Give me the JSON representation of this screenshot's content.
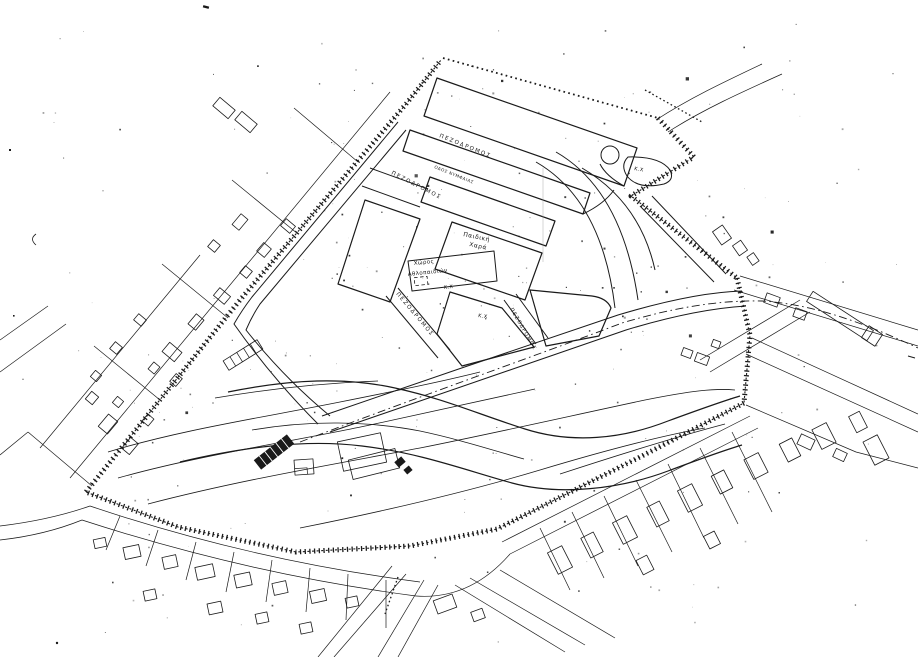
{
  "map": {
    "type": "scanned-urban-plan",
    "paper_color": "#ffffff",
    "ink_color": "#1a1a1a",
    "street_labels": [
      {
        "id": "pezodromos-1",
        "text": "ΠΕΖΟΔΡΟΜΟΣ"
      },
      {
        "id": "pezodromos-2",
        "text": "ΠΕΖΟΔΡΟΜΟΣ"
      },
      {
        "id": "pezodromos-3",
        "text": "ΠΕΖΟΔΡΟΜΟΣ"
      },
      {
        "id": "pezodromos-4",
        "text": "ΠΕΖΟΔΡΟΜΟΣ"
      },
      {
        "id": "street-name",
        "text": "ΟΔΟΣ ΝΥΜΦΑΙΑΣ"
      }
    ],
    "area_labels": [
      {
        "id": "playground",
        "line1": "Παιδική",
        "line2": "Χαρά"
      },
      {
        "id": "sports-ground",
        "line1": "Χώρος",
        "line2": "Αθλοπαιδιών"
      }
    ],
    "open_space_labels": [
      {
        "id": "kx-sports",
        "text": "Κ.Χ"
      },
      {
        "id": "kx-central",
        "text": "Κ.Χ"
      },
      {
        "id": "kx-island",
        "text": "Κ.Χ"
      }
    ]
  }
}
